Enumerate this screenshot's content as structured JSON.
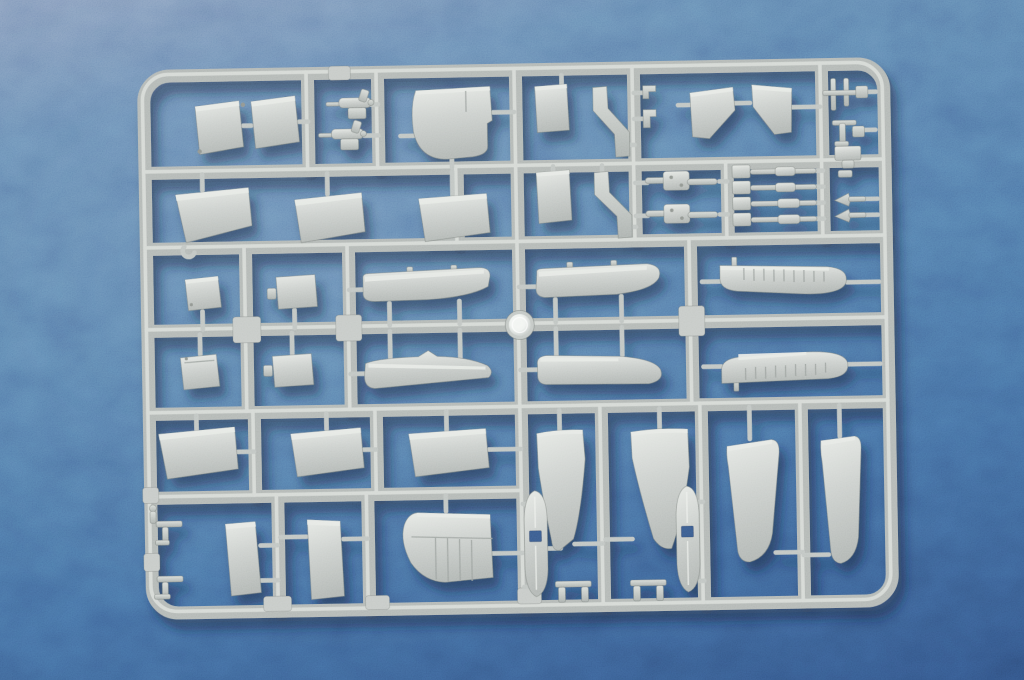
{
  "scene": {
    "subject": "injection-molded plastic model kit sprue with aircraft parts",
    "material": "light grey polystyrene",
    "background": "blue felt cloth",
    "media": "photograph",
    "center_feature": "shiny circular mold gate at sprue center"
  },
  "colors": {
    "background_top": "#7e96b8",
    "background_mid": "#4d74a5",
    "background_deep": "#2f4f7f",
    "plastic_light": "#e6e9e5",
    "plastic_mid": "#ccd0cd",
    "plastic_shade": "#b2b7b4",
    "runner_base": "#b3b8b5",
    "runner_highlight": "#dcdfdb",
    "runner_shade": "rgba(60,74,98,0.32)",
    "pin": "#c0c5c2",
    "edge": "rgba(104,110,106,0.45)",
    "hub_core": "#f7f9f6",
    "hub_ring": "#c3c8c5",
    "cast_shadow": "#0d1c38"
  },
  "sprue": {
    "frame_shape": "rounded rectangle",
    "grid_rows": 6,
    "mold_gate": "circular shiny hub at center crossing",
    "parts_total": 53
  },
  "parts": [
    "bulkhead-panel-1",
    "bulkhead-panel-2",
    "machine-gun-1",
    "machine-gun-2",
    "cowling-side-panel",
    "hatch-panel-1",
    "angled-fairing-1",
    "bracket-clip-1",
    "bracket-clip-2",
    "tailplane-half-left",
    "tailplane-half-right",
    "strut-pair",
    "tee-bracket-top",
    "flap-panel-1",
    "flap-panel-2",
    "flap-panel-3",
    "hatch-panel-2",
    "angled-fairing-2",
    "gun-breech-1",
    "gun-breech-2",
    "landing-gear-strut-1",
    "landing-gear-strut-2",
    "landing-gear-strut-3",
    "landing-gear-strut-4",
    "mount-block",
    "exhaust-stub-1",
    "exhaust-stub-2",
    "access-panel-1",
    "access-panel-2",
    "upper-wing-half-left",
    "upper-wing-half-right",
    "ribbed-wing-panel-upper",
    "ribbed-wing-panel-lower",
    "access-panel-3",
    "access-panel-4",
    "lower-wing-half-left",
    "lower-wing-half-right",
    "flap-panel-4",
    "flap-panel-5",
    "flap-panel-6",
    "fin-half-1",
    "fin-half-2",
    "float-half-1",
    "float-half-2",
    "wingtip-half-1",
    "wingtip-half-2",
    "tee-bracket-1",
    "tee-bracket-2",
    "door-panel-1",
    "door-panel-2",
    "ribbed-cowling-panel",
    "skid-bracket-1",
    "skid-bracket-2"
  ]
}
